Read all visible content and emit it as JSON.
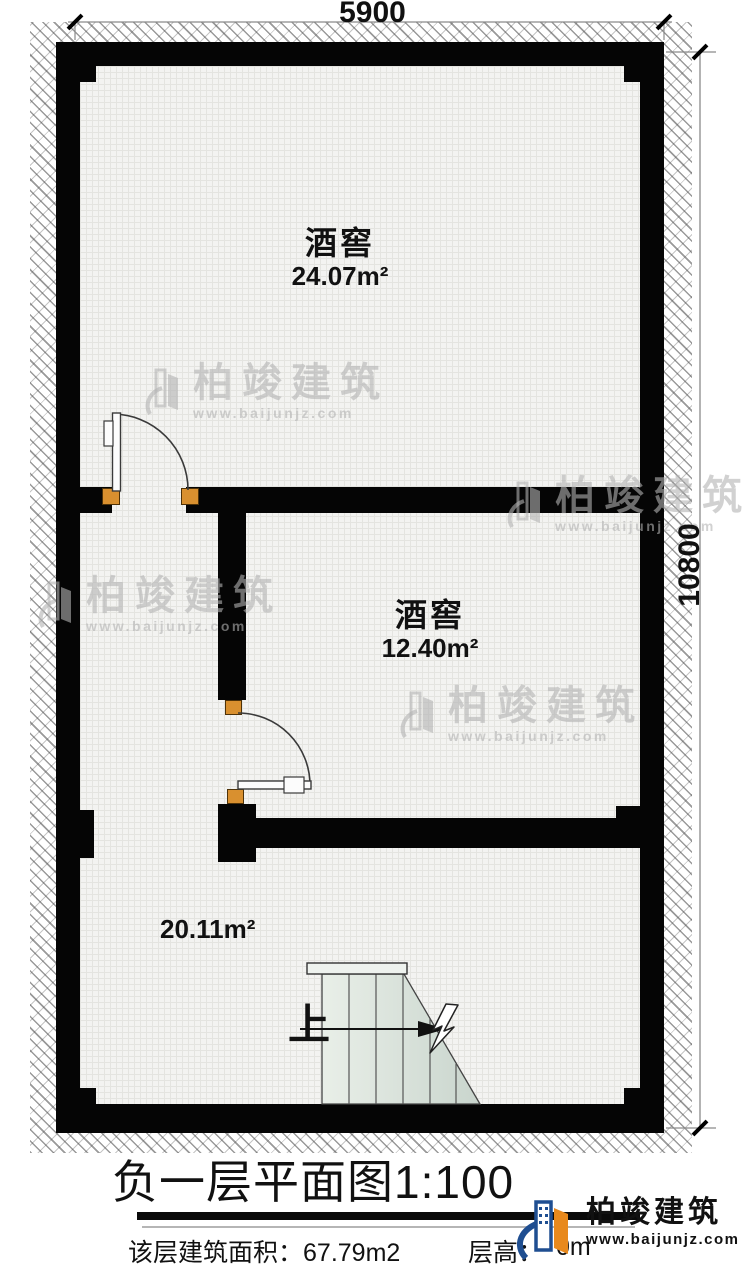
{
  "plan": {
    "dim_top": "5900",
    "dim_right": "10800",
    "rooms": [
      {
        "name": "酒窖",
        "area": "24.07m²"
      },
      {
        "name": "酒窖",
        "area": "12.40m²"
      },
      {
        "name": "",
        "area": "20.11m²"
      }
    ],
    "stairs_up_label": "上"
  },
  "watermark": {
    "brand": "柏竣建筑",
    "url": "www.baijunjz.com"
  },
  "title_block": {
    "title": "负一层平面图",
    "scale": "1:100",
    "area_label": "该层建筑面积：",
    "area_value": "67.79m2",
    "height_label": "层高：",
    "height_visible": "0m"
  },
  "logo": {
    "brand": "柏竣建筑",
    "url": "www.baijunjz.com"
  },
  "colors": {
    "wall": "#050505",
    "door_stop": "#d9902f",
    "logo_blue": "#1f4e91",
    "logo_orange": "#e8891d",
    "stair_fill_light": "#e9efe8",
    "stair_fill_dark": "#c9d5cd"
  }
}
